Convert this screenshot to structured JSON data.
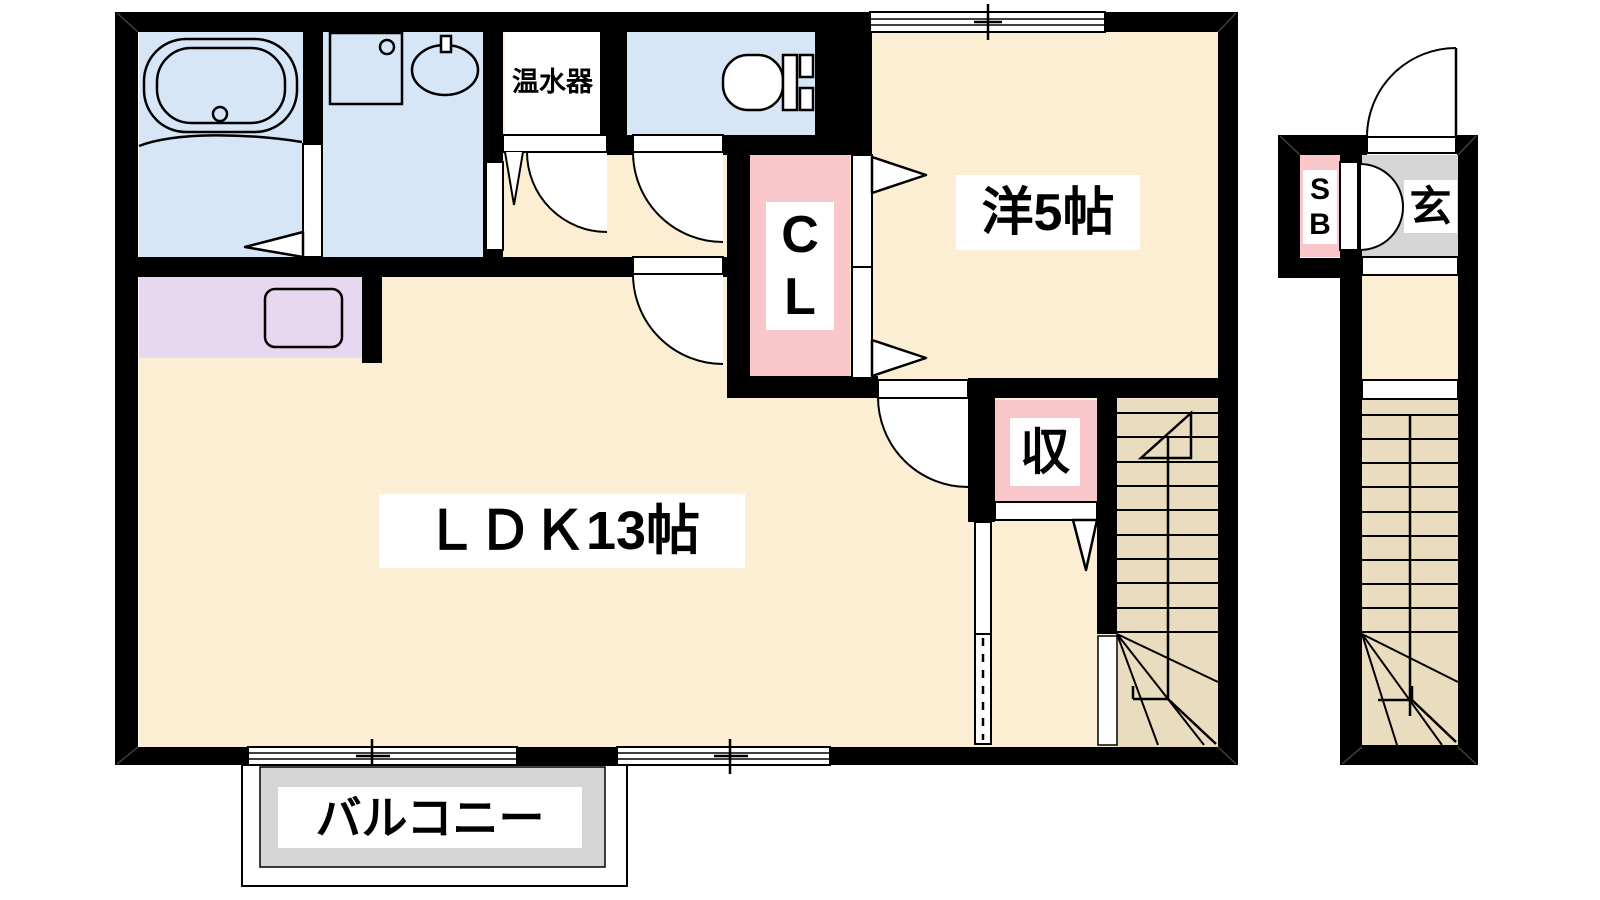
{
  "floorplan": {
    "rooms": {
      "ldk": {
        "label": "ＬＤＫ13帖"
      },
      "western": {
        "label": "洋5帖"
      },
      "closet": {
        "line1": "C",
        "line2": "L"
      },
      "storage": {
        "label": "収"
      },
      "water_heater": {
        "label": "温水器"
      },
      "balcony": {
        "label": "バルコニー"
      },
      "shoe_box": {
        "line1": "S",
        "line2": "B"
      },
      "entrance": {
        "label": "玄"
      }
    },
    "colors": {
      "room_cream": "#FBEED3",
      "stairs_tan": "#E9DCBF",
      "wet_area_blue": "#D7E6F7",
      "closet_pink": "#F9C6CA",
      "kitchen_purple": "#E8D7F0",
      "entrance_gray": "#D5D5D5",
      "wall_black": "#000000"
    }
  }
}
